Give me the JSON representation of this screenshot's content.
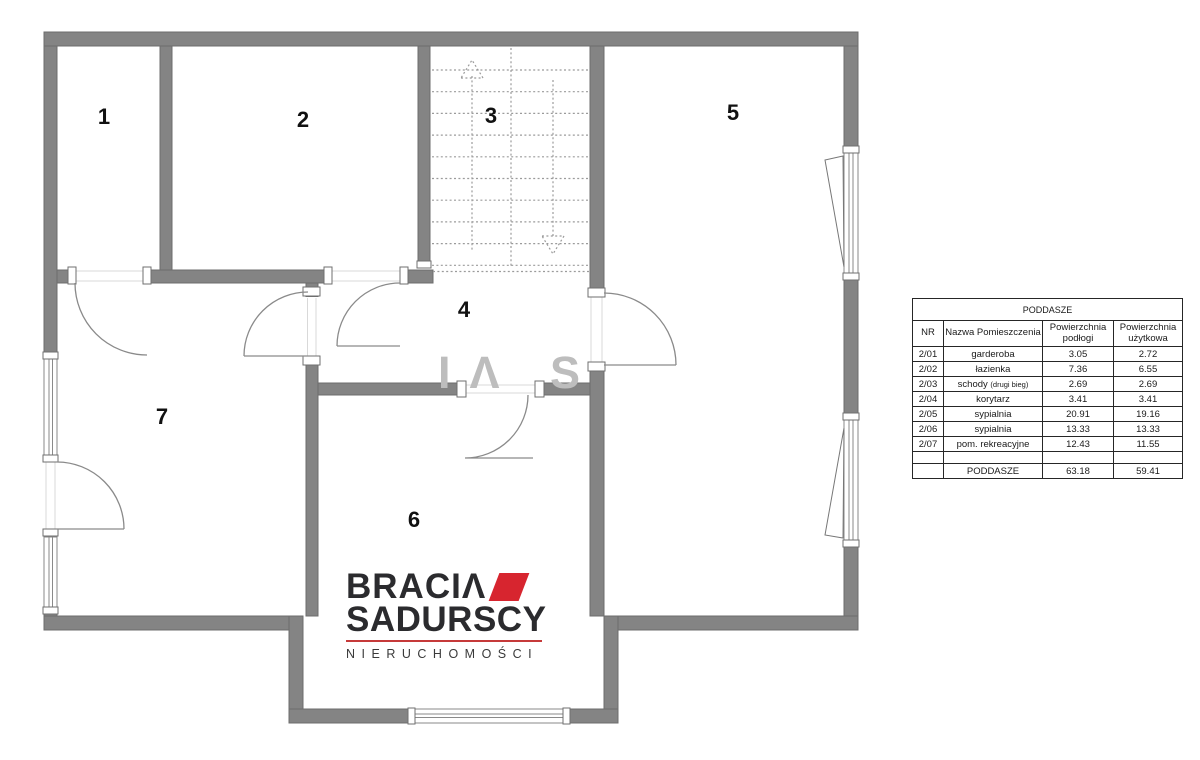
{
  "plan": {
    "room_labels": [
      "1",
      "2",
      "3",
      "4",
      "5",
      "6",
      "7"
    ]
  },
  "watermark": {
    "text": "IΛ S"
  },
  "logo": {
    "word1": "BRACIΛ",
    "word2": "SADURSCY",
    "word3": "NIERUCHOMOŚCI",
    "accent_red": "#d7252f"
  },
  "colors": {
    "wall_gray": "#848484"
  },
  "table": {
    "title": "PODDASZE",
    "headers": {
      "nr": "NR",
      "name": "Nazwa Pomieszczenia",
      "floor": "Powierzchnia podłogi",
      "usable": "Powierzchnia użytkowa"
    },
    "rows": [
      {
        "nr": "2/01",
        "name": "garderoba",
        "floor": "3.05",
        "usable": "2.72"
      },
      {
        "nr": "2/02",
        "name": "łazienka",
        "floor": "7.36",
        "usable": "6.55"
      },
      {
        "nr": "2/03",
        "name": "schody",
        "name_small": "(drugi bieg)",
        "floor": "2.69",
        "usable": "2.69"
      },
      {
        "nr": "2/04",
        "name": "korytarz",
        "floor": "3.41",
        "usable": "3.41"
      },
      {
        "nr": "2/05",
        "name": "sypialnia",
        "floor": "20.91",
        "usable": "19.16"
      },
      {
        "nr": "2/06",
        "name": "sypialnia",
        "floor": "13.33",
        "usable": "13.33"
      },
      {
        "nr": "2/07",
        "name": "pom. rekreacyjne",
        "floor": "12.43",
        "usable": "11.55"
      },
      {
        "nr": "",
        "name": "",
        "floor": "",
        "usable": ""
      },
      {
        "nr": "",
        "name": "PODDASZE",
        "floor": "63.18",
        "usable": "59.41"
      }
    ]
  }
}
